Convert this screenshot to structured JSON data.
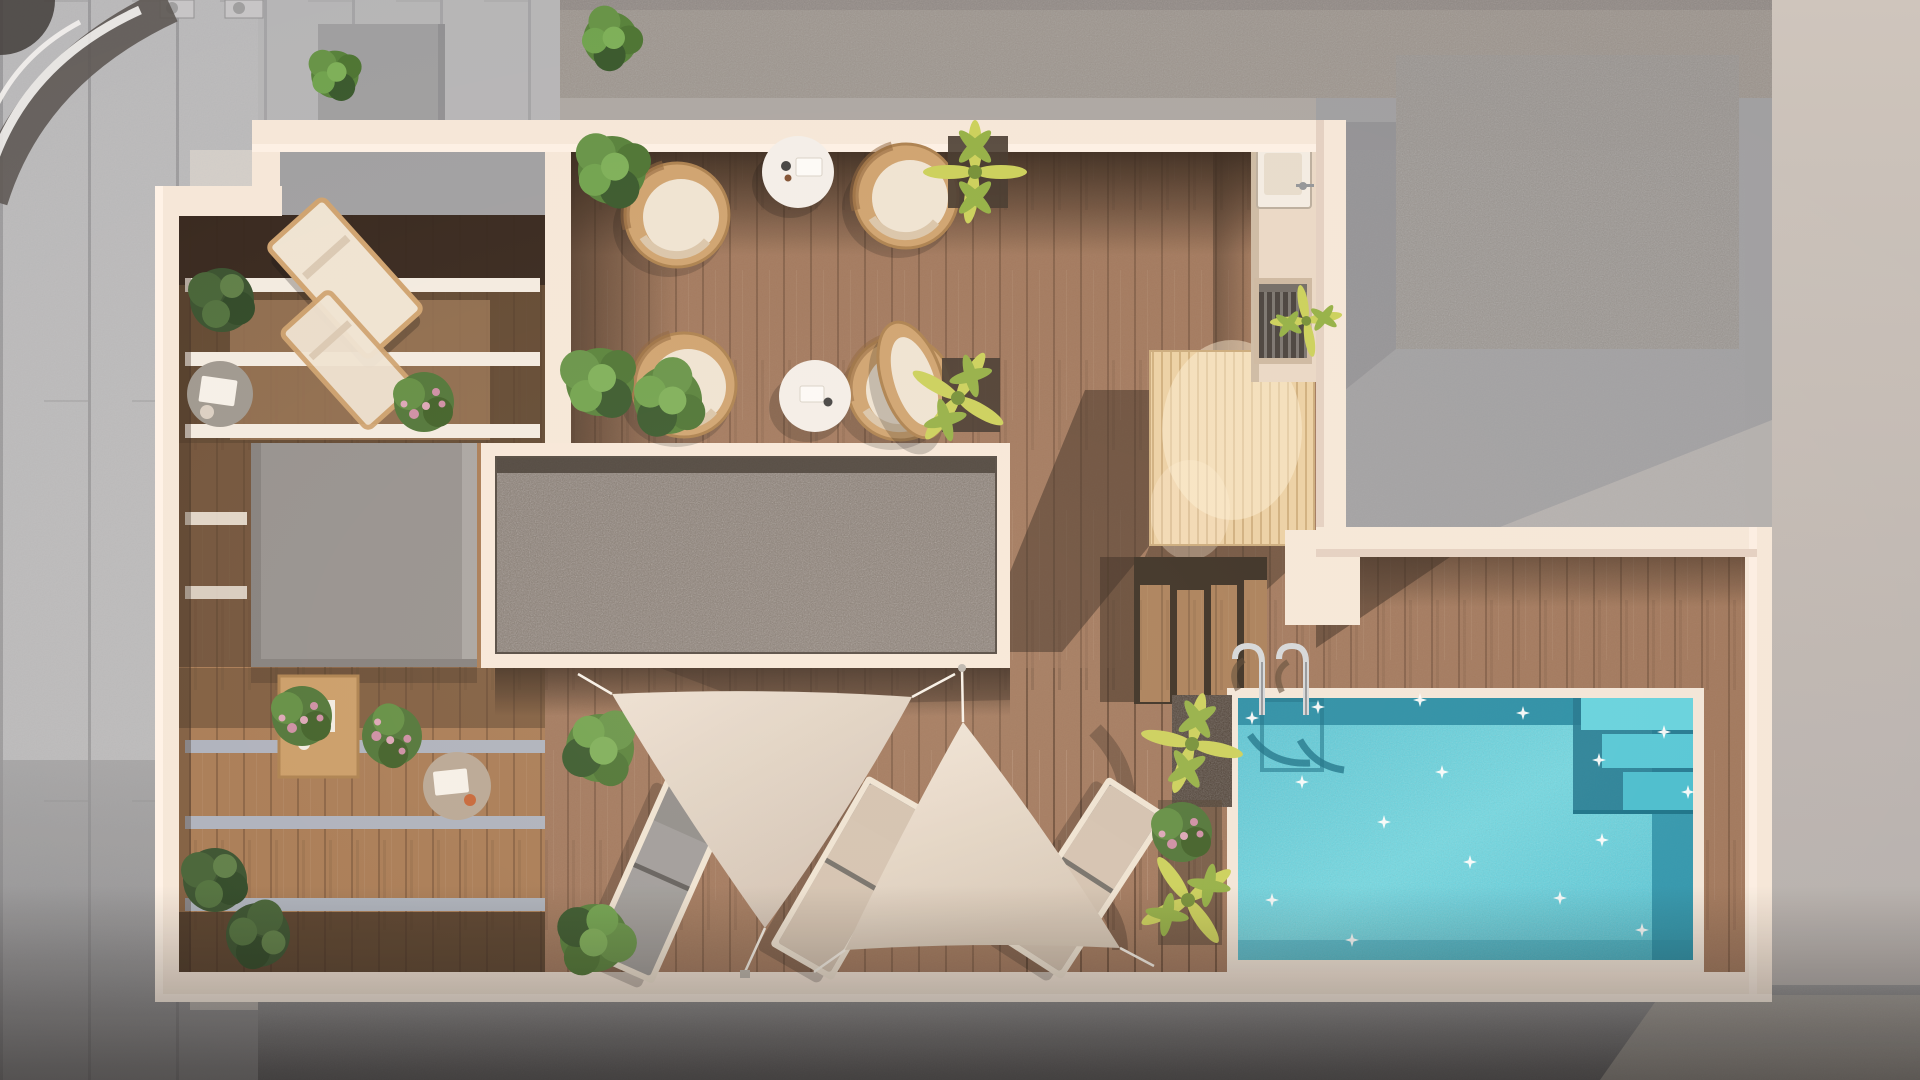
{
  "meta": {
    "description": "Top-down 3D architectural rendering of a rooftop terrace with wooden deck, pergola balconies, shade sails, outdoor kitchen, gravel skylight and swimming pool",
    "width": 1920,
    "height": 1080
  },
  "colors": {
    "pavement": "#b7b8ba",
    "pavementLine": "#a4a5a7",
    "roofTexture": "#96908a",
    "roofTopStrip": "#8a8480",
    "roofBand": "#a9a5a1",
    "neighborGray": "#9c9da0",
    "rightLightTop": "#cdc4bc",
    "rightLightBottom": "#b0acaa",
    "groundBottom": "#8f9092",
    "groundVignette": "#55565a",
    "wall": "#f6e8da",
    "wallBright": "#fff4e8",
    "wallShade": "#e3d0c1",
    "deck": "#9c7154",
    "deckDark": "#7c5a40",
    "deckShadow": "#2c1e13",
    "slatDark": "#44311f",
    "leftDeck": "#a4764e",
    "beamWhite": "#f3ece2",
    "beamBlue": "#a9b0bc",
    "grayBox": "#908d8b",
    "grayBoxEdge": "#a5a2a0",
    "gravel": "#7b7169",
    "gravelShadow": "#39312a",
    "skylightFrame": "#f7e9db",
    "platformWood": "#ecd0a2",
    "platformLine": "#d3b076",
    "counter": "#e9d9c6",
    "sinkWhite": "#f4eee4",
    "grillDark": "#3f3a36",
    "poolLight": "#63d8e5",
    "poolMain": "#45c3d6",
    "poolDeep": "#1b86a0",
    "coping": "#f3e7da",
    "ladderChrome": "#d3d8db",
    "sailA": "#e0d4c5",
    "sailB": "#eadfd0",
    "rope": "#f8f3ea",
    "loungerGray": "#9b9997",
    "loungerBeige": "#d8c7b3",
    "cushionCream": "#efe4d3",
    "wickerTan": "#cda06a",
    "tableWhite": "#f4f0ea",
    "tableGray": "#9a948c",
    "tableTaupe": "#b5a491",
    "woodSeat": "#c89a62",
    "bushGreen": "#4f7d33",
    "bushDark": "#2f5224",
    "fernDark": "#2e4a26",
    "palmYellow": "#c9d054",
    "palmGreen": "#8fae3e",
    "flowerPink": "#cb8aa2",
    "soilDark": "#3c3026"
  },
  "scene": {
    "areas": [
      {
        "name": "left-pergola-balconies"
      },
      {
        "name": "dining-deck"
      },
      {
        "name": "outdoor-kitchen"
      },
      {
        "name": "gravel-skylight"
      },
      {
        "name": "roof-access-box"
      },
      {
        "name": "timber-platform"
      },
      {
        "name": "deck-stairs"
      },
      {
        "name": "pool-terrace"
      },
      {
        "name": "swimming-pool"
      },
      {
        "name": "shade-sail-area"
      }
    ],
    "furniture": [
      {
        "name": "wicker-chair",
        "count": 4
      },
      {
        "name": "round-coffee-table",
        "count": 2
      },
      {
        "name": "lounge-chair",
        "count": 2
      },
      {
        "name": "sun-lounger",
        "count": 3
      },
      {
        "name": "egg-chair",
        "count": 1
      },
      {
        "name": "side-table",
        "count": 3
      },
      {
        "name": "pool-ladder",
        "count": 1
      }
    ],
    "plants": [
      {
        "name": "green-bush",
        "count": 6
      },
      {
        "name": "yellow-palm",
        "count": 5
      },
      {
        "name": "flower-shrub",
        "count": 4
      },
      {
        "name": "dark-fern",
        "count": 3
      }
    ]
  }
}
